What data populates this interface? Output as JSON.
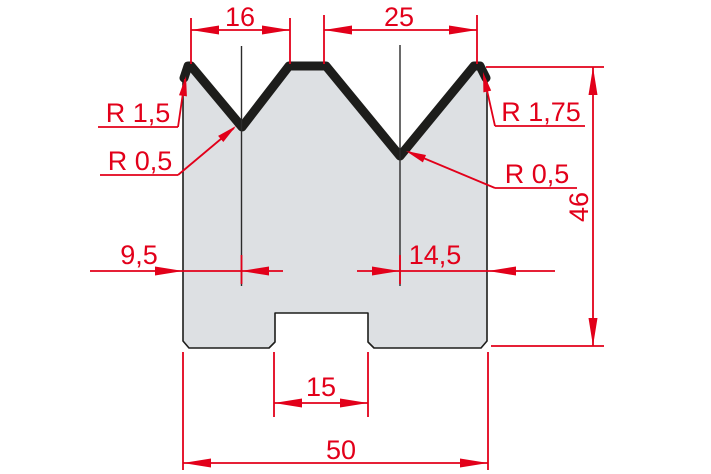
{
  "colors": {
    "dimension_red": "#e2001a",
    "outline_black": "#1d1d1b",
    "part_fill": "#dde0e3",
    "background": "#ffffff"
  },
  "drawing": {
    "dimensions": {
      "v_left_opening": "16",
      "v_right_opening": "25",
      "radius_top_left": "R 1,5",
      "radius_v_left": "R 0,5",
      "radius_top_right": "R 1,75",
      "radius_v_right": "R 0,5",
      "total_height": "46",
      "v_left_offset": "9,5",
      "v_right_offset": "14,5",
      "slot_width": "15",
      "total_width": "50"
    }
  }
}
